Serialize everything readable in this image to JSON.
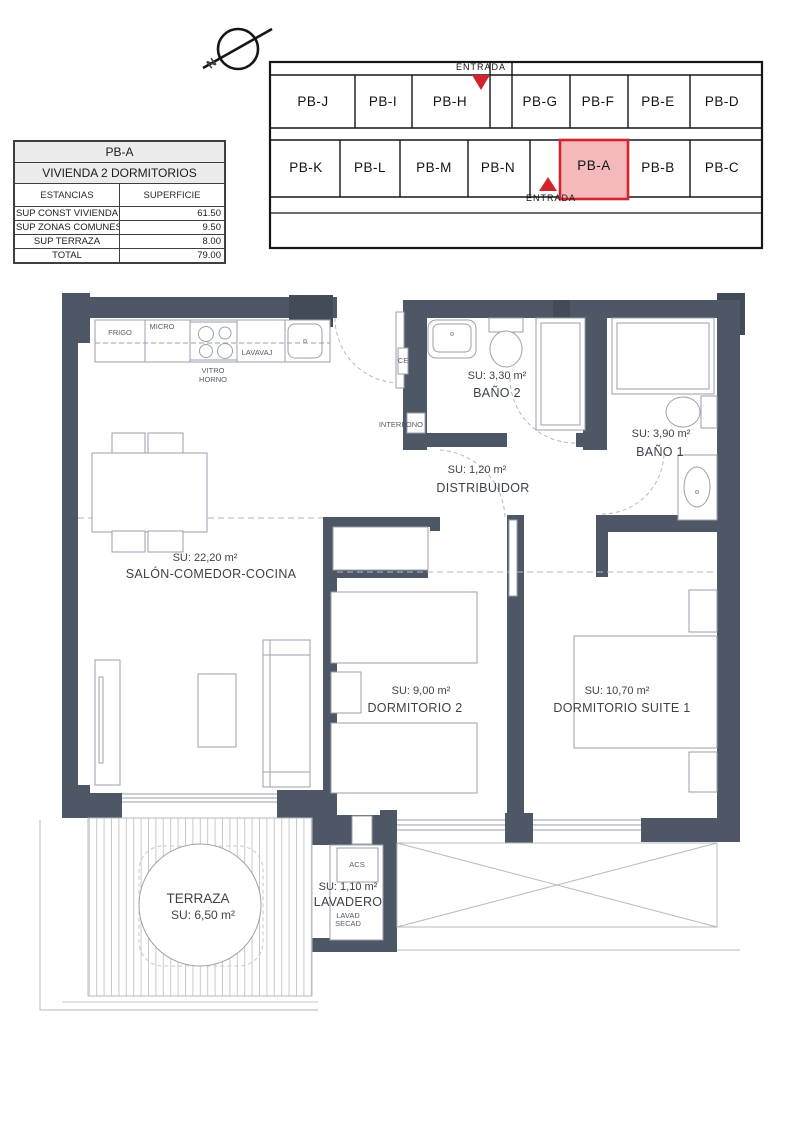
{
  "colors": {
    "wall": "#4d5766",
    "wall_dark": "#424c59",
    "line": "#9aa2ac",
    "dashed": "#b3b8bf",
    "red": "#d3242b",
    "pink": "#f5b9bc",
    "text": "#3c434c"
  },
  "info_table": {
    "unit": "PB-A",
    "subtitle": "VIVIENDA 2 DORMITORIOS",
    "col_estancias": "ESTANCIAS",
    "col_superficie": "SUPERFICIE",
    "rows": [
      {
        "label": "SUP CONST VIVIENDA",
        "value": "61.50"
      },
      {
        "label": "SUP ZONAS COMUNES",
        "value": "9.50"
      },
      {
        "label": "SUP TERRAZA",
        "value": "8.00"
      },
      {
        "label": "TOTAL",
        "value": "79.00"
      }
    ]
  },
  "key_plan": {
    "north_letter": "N",
    "entrada_top": "ENTRADA",
    "entrada_bottom": "ENTRADA",
    "highlighted_unit": "PB-A",
    "top_row": [
      "PB-J",
      "PB-I",
      "PB-H",
      "PB-G",
      "PB-F",
      "PB-E",
      "PB-D"
    ],
    "bottom_row": [
      "PB-K",
      "PB-L",
      "PB-M",
      "PB-N",
      "PB-A",
      "PB-B",
      "PB-C"
    ]
  },
  "rooms": {
    "salon": {
      "su": "SU: 22,20 m²",
      "name": "SALÓN-COMEDOR-COCINA"
    },
    "bano2": {
      "su": "SU: 3,30 m²",
      "name": "BAÑO 2"
    },
    "bano1": {
      "su": "SU: 3,90 m²",
      "name": "BAÑO 1"
    },
    "distribuidor": {
      "su": "SU: 1,20 m²",
      "name": "DISTRIBUIDOR"
    },
    "dormitorio2": {
      "su": "SU: 9,00 m²",
      "name": "DORMITORIO  2"
    },
    "suite": {
      "su": "SU: 10,70 m²",
      "name": "DORMITORIO SUITE 1"
    },
    "terraza": {
      "name": "TERRAZA",
      "su": "SU: 6,50 m²"
    },
    "lavadero": {
      "su": "SU: 1,10 m²",
      "name": "LAVADERO",
      "lavad": "LAVAD",
      "secad": "SECAD",
      "acs": "ACS"
    }
  },
  "kitchen": {
    "frigo": "FRIGO",
    "micro": "MICRO",
    "vitro": "VITRO",
    "horno": "HORNO",
    "lavavaj": "LAVAVAJ"
  },
  "misc": {
    "interfono": "INTERFONO",
    "ce": "CE"
  }
}
